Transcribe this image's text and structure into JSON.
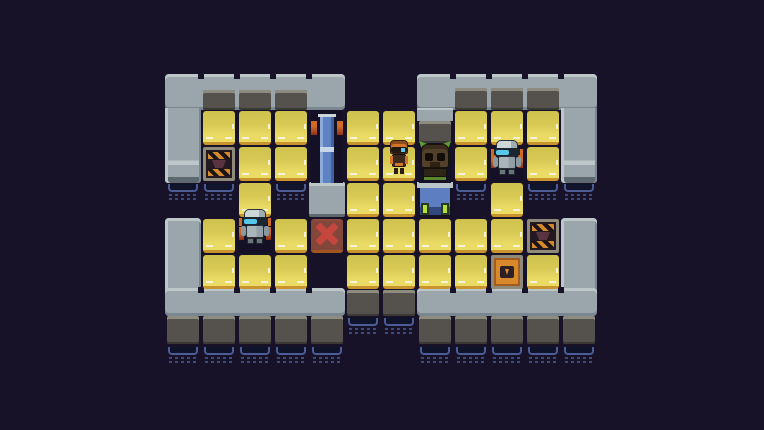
{
  "scene": {
    "width": 764,
    "height": 430,
    "background": "#181228",
    "grid": {
      "cols": 12,
      "rows": 8,
      "tile": 36,
      "origin_x": 165,
      "origin_y": 74
    }
  },
  "palette": {
    "bg": "#181228",
    "platform": "#9aa5ac",
    "platform_light": "#bdc7ca",
    "platform_dark": "#7b8790",
    "face": "#55524d",
    "face_edge": "#8e8b81",
    "face_shadow": "#3b3935",
    "floor": "#d8ca55",
    "floor_light": "#e9db64",
    "floor_shade": "#cec14d",
    "floor_edge": "#c9942d",
    "dash": "#f7f2da",
    "water_line": "#4c5c96",
    "water_fill": "#10142a",
    "water_dot": "#3d4a7c",
    "door_blue": "#5e83c4",
    "door_blue_light": "#8fabdc",
    "door_blue_dark": "#41619f",
    "door_band": "#c7d6e8",
    "marker_orange": "#d06a25",
    "marker_core": "#8e2f1a",
    "x_body": "#82463a",
    "x_red": "#c5463d",
    "crate_frame": "#8f8a7a",
    "crate_dark": "#221a20",
    "hazard_orange": "#d4892b",
    "envelope_orange": "#d8892c",
    "envelope_dark": "#2c2026",
    "robot_light": "#cdd7d8",
    "robot_mid": "#a9b5ba",
    "robot_dark": "#69757b",
    "visor": "#1c2631",
    "visor_glow": "#57c8e9",
    "bot_orange": "#d2752b",
    "bot_orange_dark": "#8e4d1a",
    "creature_brown": "#52402b",
    "creature_dark": "#2f2418",
    "creature_green": "#5f9e33",
    "machine_blue": "#5d7ec0",
    "lamp_green": "#b4e03c",
    "pad_bg": "#141026"
  },
  "platforms": [
    {
      "name": "top-left-platform",
      "kind": "bar",
      "x": 165,
      "y": 74,
      "w": 180,
      "h": 36
    },
    {
      "name": "top-right-platform",
      "kind": "bar",
      "x": 417,
      "y": 74,
      "w": 180,
      "h": 36
    },
    {
      "name": "left-wall",
      "kind": "wall-top",
      "x": 165,
      "y": 108,
      "w": 36,
      "h": 75
    },
    {
      "name": "right-wall",
      "kind": "wall-top",
      "x": 561,
      "y": 108,
      "w": 36,
      "h": 75
    },
    {
      "name": "right-inner-wall-stub",
      "kind": "stub",
      "x": 417,
      "y": 108,
      "w": 36,
      "h": 13
    },
    {
      "name": "bottom-left-wall",
      "kind": "wall-bottom",
      "x": 165,
      "y": 218,
      "w": 36,
      "h": 74
    },
    {
      "name": "bottom-right-wall",
      "kind": "wall-bottom",
      "x": 561,
      "y": 218,
      "w": 36,
      "h": 74
    },
    {
      "name": "bottom-left-platform",
      "kind": "bar",
      "x": 165,
      "y": 288,
      "w": 180,
      "h": 28
    },
    {
      "name": "bottom-right-platform",
      "kind": "bar",
      "x": 417,
      "y": 288,
      "w": 180,
      "h": 28
    }
  ],
  "faces": [
    {
      "x": 203,
      "y": 90,
      "w": 32,
      "h": 20
    },
    {
      "x": 239,
      "y": 90,
      "w": 32,
      "h": 20
    },
    {
      "x": 275,
      "y": 90,
      "w": 32,
      "h": 20
    },
    {
      "x": 455,
      "y": 88,
      "w": 32,
      "h": 22
    },
    {
      "x": 491,
      "y": 88,
      "w": 32,
      "h": 22
    },
    {
      "x": 527,
      "y": 88,
      "w": 32,
      "h": 22
    },
    {
      "x": 419,
      "y": 121,
      "w": 32,
      "h": 22
    },
    {
      "x": 347,
      "y": 290,
      "w": 32,
      "h": 26
    },
    {
      "x": 383,
      "y": 290,
      "w": 32,
      "h": 26
    },
    {
      "x": 167,
      "y": 316,
      "w": 32,
      "h": 28
    },
    {
      "x": 203,
      "y": 316,
      "w": 32,
      "h": 28
    },
    {
      "x": 239,
      "y": 316,
      "w": 32,
      "h": 28
    },
    {
      "x": 275,
      "y": 316,
      "w": 32,
      "h": 28
    },
    {
      "x": 311,
      "y": 316,
      "w": 32,
      "h": 28
    },
    {
      "x": 419,
      "y": 316,
      "w": 32,
      "h": 28
    },
    {
      "x": 455,
      "y": 316,
      "w": 32,
      "h": 28
    },
    {
      "x": 491,
      "y": 316,
      "w": 32,
      "h": 28
    },
    {
      "x": 527,
      "y": 316,
      "w": 32,
      "h": 28
    },
    {
      "x": 563,
      "y": 316,
      "w": 32,
      "h": 28
    }
  ],
  "water": [
    {
      "x": 168,
      "y": 184
    },
    {
      "x": 204,
      "y": 184
    },
    {
      "x": 276,
      "y": 184
    },
    {
      "x": 456,
      "y": 184
    },
    {
      "x": 528,
      "y": 184
    },
    {
      "x": 564,
      "y": 184
    },
    {
      "x": 348,
      "y": 318
    },
    {
      "x": 384,
      "y": 318
    },
    {
      "x": 168,
      "y": 347
    },
    {
      "x": 204,
      "y": 347
    },
    {
      "x": 240,
      "y": 347
    },
    {
      "x": 276,
      "y": 347
    },
    {
      "x": 312,
      "y": 347
    },
    {
      "x": 420,
      "y": 347
    },
    {
      "x": 456,
      "y": 347
    },
    {
      "x": 492,
      "y": 347
    },
    {
      "x": 528,
      "y": 347
    },
    {
      "x": 564,
      "y": 347
    }
  ],
  "grid_tiles": [
    {
      "type": "floor",
      "col": 1,
      "row": 1
    },
    {
      "type": "floor",
      "col": 2,
      "row": 1
    },
    {
      "type": "floor",
      "col": 3,
      "row": 1
    },
    {
      "type": "floor",
      "col": 5,
      "row": 1
    },
    {
      "type": "floor",
      "col": 6,
      "row": 1
    },
    {
      "type": "floor",
      "col": 8,
      "row": 1
    },
    {
      "type": "floor",
      "col": 9,
      "row": 1
    },
    {
      "type": "floor",
      "col": 10,
      "row": 1
    },
    {
      "type": "floor",
      "col": 2,
      "row": 2
    },
    {
      "type": "floor",
      "col": 3,
      "row": 2
    },
    {
      "type": "floor",
      "col": 5,
      "row": 2
    },
    {
      "type": "floor",
      "col": 6,
      "row": 2
    },
    {
      "type": "floor",
      "col": 8,
      "row": 2
    },
    {
      "type": "floor",
      "col": 10,
      "row": 2
    },
    {
      "type": "floor",
      "col": 2,
      "row": 3
    },
    {
      "type": "floor",
      "col": 5,
      "row": 3
    },
    {
      "type": "floor",
      "col": 6,
      "row": 3
    },
    {
      "type": "floor",
      "col": 9,
      "row": 3
    },
    {
      "type": "floor",
      "col": 1,
      "row": 4
    },
    {
      "type": "floor",
      "col": 3,
      "row": 4
    },
    {
      "type": "floor",
      "col": 5,
      "row": 4
    },
    {
      "type": "floor",
      "col": 6,
      "row": 4
    },
    {
      "type": "floor",
      "col": 7,
      "row": 4
    },
    {
      "type": "floor",
      "col": 8,
      "row": 4
    },
    {
      "type": "floor",
      "col": 9,
      "row": 4
    },
    {
      "type": "floor",
      "col": 1,
      "row": 5
    },
    {
      "type": "floor",
      "col": 2,
      "row": 5
    },
    {
      "type": "floor",
      "col": 3,
      "row": 5
    },
    {
      "type": "floor",
      "col": 5,
      "row": 5
    },
    {
      "type": "floor",
      "col": 6,
      "row": 5
    },
    {
      "type": "floor",
      "col": 7,
      "row": 5
    },
    {
      "type": "floor",
      "col": 8,
      "row": 5
    },
    {
      "type": "floor",
      "col": 10,
      "row": 5
    },
    {
      "type": "crate-hazard",
      "col": 1,
      "row": 2
    },
    {
      "type": "crate-hazard",
      "col": 10,
      "row": 4
    },
    {
      "type": "crate-envelope",
      "col": 9,
      "row": 5
    },
    {
      "type": "target-x",
      "col": 4,
      "row": 4
    },
    {
      "type": "pad",
      "col": 2,
      "row": 4
    },
    {
      "type": "pad",
      "col": 9,
      "row": 2
    },
    {
      "type": "door-cap",
      "col": 4,
      "row": 3
    },
    {
      "type": "dock",
      "col": 7,
      "row": 3
    }
  ],
  "structures": [
    {
      "type": "door",
      "name": "blue-door",
      "x": 311,
      "y": 110,
      "w": 32,
      "h": 73
    },
    {
      "type": "alcove",
      "name": "creature-alcove",
      "x": 419,
      "y": 143,
      "w": 32,
      "h": 40
    }
  ],
  "entities": [
    {
      "type": "robot-gray",
      "name": "gray-robot-top",
      "x": 491,
      "y": 138
    },
    {
      "type": "robot-gray",
      "name": "gray-robot-bottom",
      "x": 239,
      "y": 207
    },
    {
      "type": "robot-orange",
      "name": "orange-robot",
      "x": 388,
      "y": 139
    },
    {
      "type": "creature",
      "name": "creature",
      "x": 418,
      "y": 141
    }
  ]
}
